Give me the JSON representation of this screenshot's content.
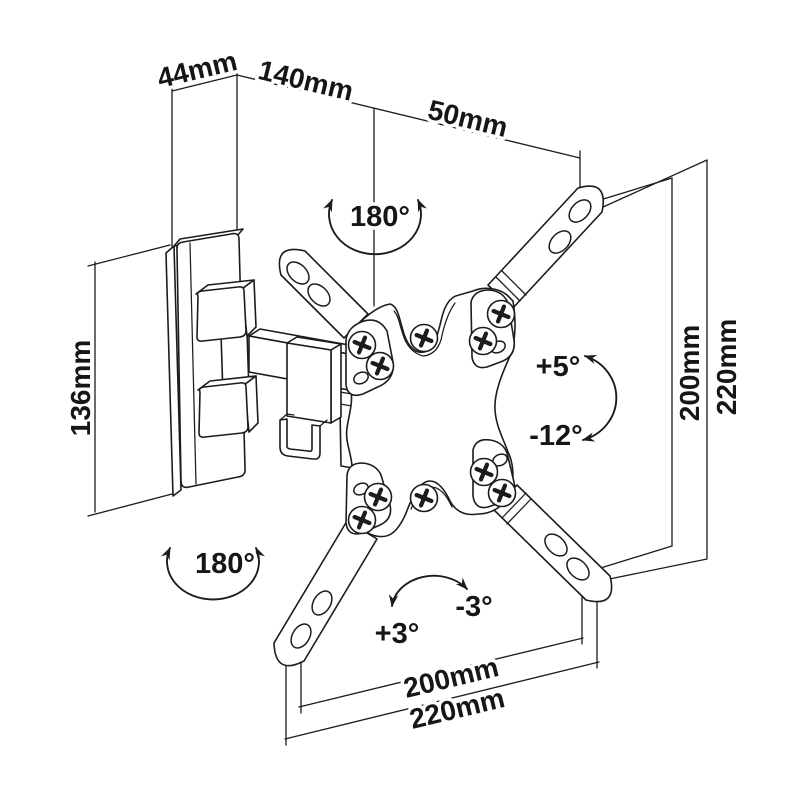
{
  "diagram": {
    "background_color": "#ffffff",
    "line_color": "#1c1c1c",
    "dimensions": {
      "wall_plate_depth": "44mm",
      "arm_length": "140mm",
      "head_depth": "50mm",
      "wall_plate_height": "136mm",
      "vesa_height_right": "200mm",
      "overall_height_right": "220mm",
      "vesa_width_bottom": "200mm",
      "overall_width_bottom": "220mm"
    },
    "angles": {
      "swivel_top": "180°",
      "swivel_bottom": "180°",
      "tilt_up": "+5°",
      "tilt_down": "-12°",
      "rotation_plus": "+3°",
      "rotation_minus": "-3°"
    }
  }
}
